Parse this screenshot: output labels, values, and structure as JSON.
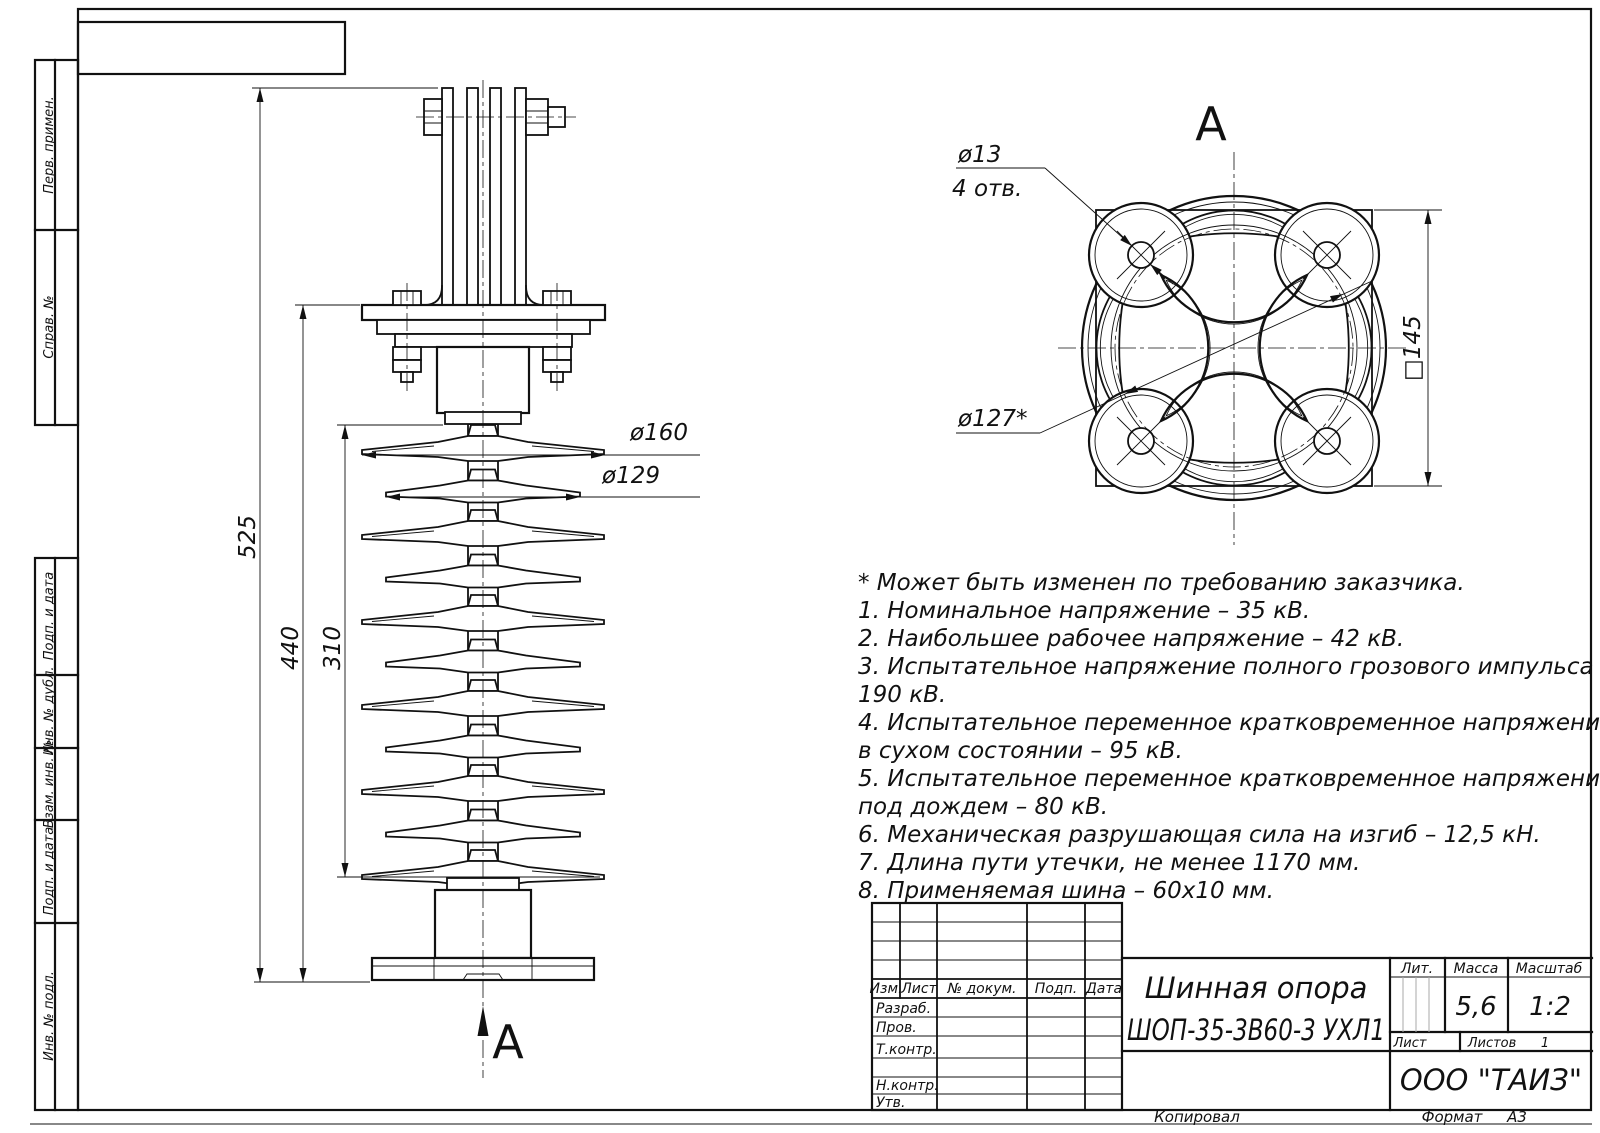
{
  "drawing": {
    "title_line1": "Шинная опора",
    "title_line2": "ШОП-35-3В60-3 УХЛ1",
    "company": "ООО \"ТАИЗ\"",
    "mass_value": "5,6",
    "scale_value": "1:2",
    "sheets_value": "1",
    "copied_label": "Копировал",
    "format_label": "Формат",
    "format_value": "А3"
  },
  "title_block": {
    "col_izm": "Изм.",
    "col_list": "Лист",
    "col_doc": "№ докум.",
    "col_sign": "Подп.",
    "col_date": "Дата",
    "row_razrab": "Разраб.",
    "row_prov": "Пров.",
    "row_tkontr": "Т.контр.",
    "row_nkontr": "Н.контр.",
    "row_utv": "Утв.",
    "lit_label": "Лит.",
    "mass_label": "Масса",
    "scale_label": "Масштаб",
    "sheet_label": "Лист",
    "sheets_label": "Листов"
  },
  "sidebar": {
    "perv_primen": "Перв. примен.",
    "sprav_no": "Справ. №",
    "podp_data1": "Подп. и дата",
    "inv_dubl": "Инв. № дубл.",
    "vzam_inv": "Взам. инв. №",
    "podp_data2": "Подп. и дата",
    "inv_podl": "Инв. № подл."
  },
  "notes": {
    "lines": [
      "* Может быть изменен по требованию заказчика.",
      "1. Номинальное напряжение – 35 кВ.",
      "2. Наибольшее рабочее напряжение – 42 кВ.",
      "3. Испытательное напряжение полного грозового импульса –",
      "190 кВ.",
      "4. Испытательное переменное кратковременное напряжение",
      "в сухом состоянии – 95 кВ.",
      "5. Испытательное переменное кратковременное напряжение",
      "под дождем – 80 кВ.",
      "6. Механическая разрушающая сила на изгиб – 12,5 кН.",
      "7. Длина пути утечки, не менее 1170 мм.",
      "8. Применяемая шина – 60x10 мм."
    ]
  },
  "front_view": {
    "dim_525": "525",
    "dim_440": "440",
    "dim_310": "310",
    "dim_d160": "ø160",
    "dim_d129": "ø129",
    "view_arrow_label": "А"
  },
  "top_view": {
    "view_label": "А",
    "dim_d13": "ø13",
    "dim_holes": "4 отв.",
    "dim_d127": "ø127*",
    "dim_square": "□145"
  }
}
